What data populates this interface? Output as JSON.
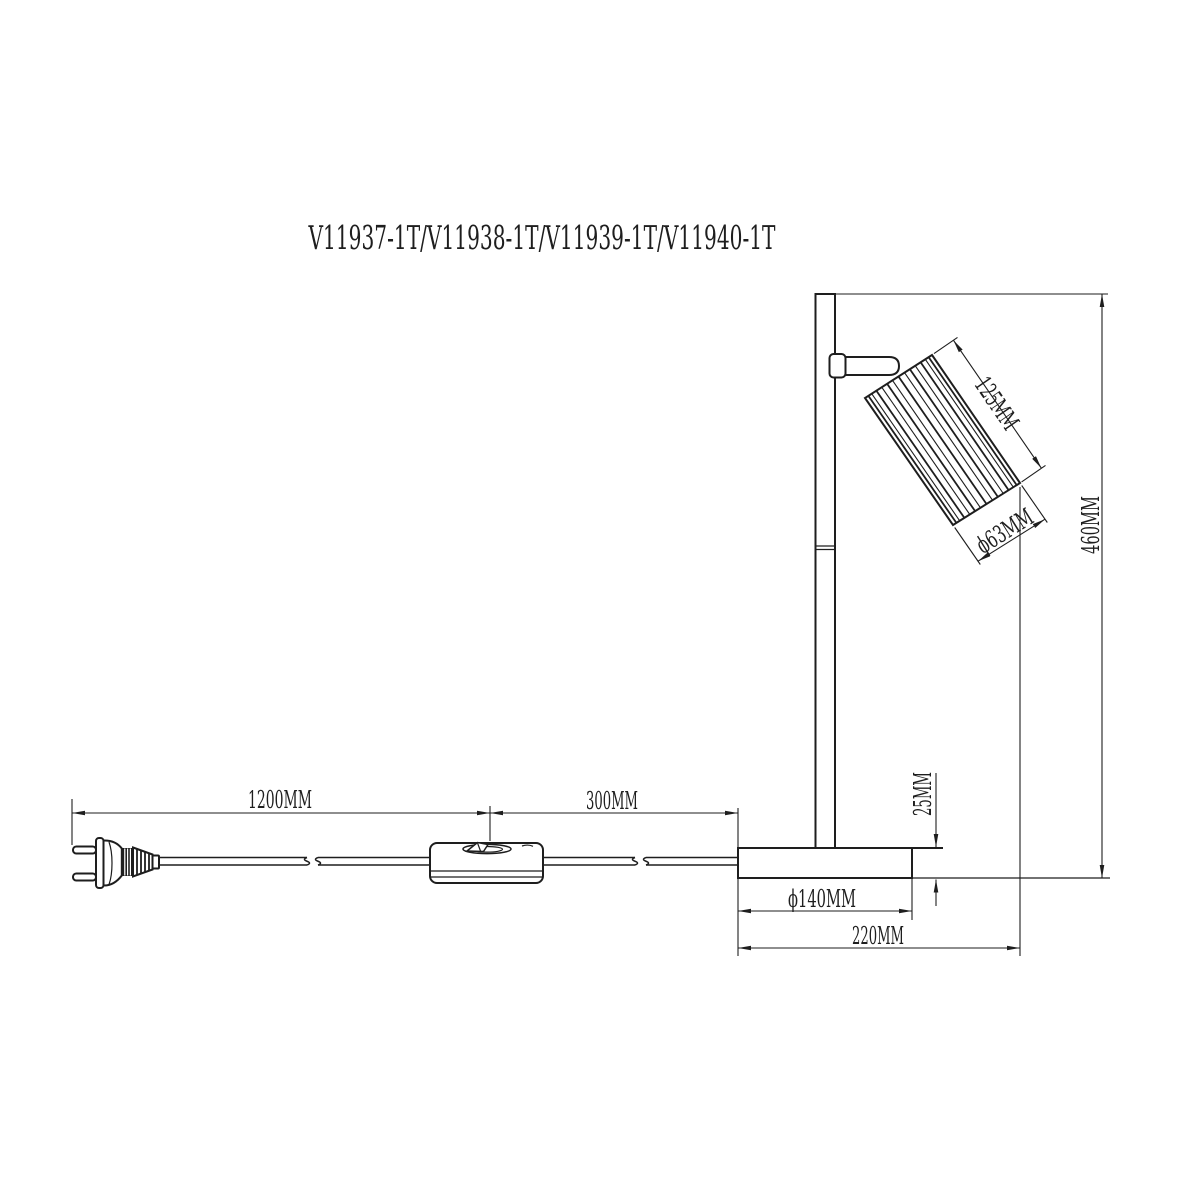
{
  "title": "V11937-1T/V11938-1T/V11939-1T/V11940-1T",
  "dimensions": {
    "cord_plug_to_switch": "1200MM",
    "switch_to_base": "300MM",
    "head_length": "125MM",
    "head_diameter": "ϕ63MM",
    "overall_height": "460MM",
    "base_thickness": "25MM",
    "base_diameter": "ϕ140MM",
    "overall_depth": "220MM"
  },
  "colors": {
    "line": "#1e1e1e",
    "background": "#ffffff"
  }
}
